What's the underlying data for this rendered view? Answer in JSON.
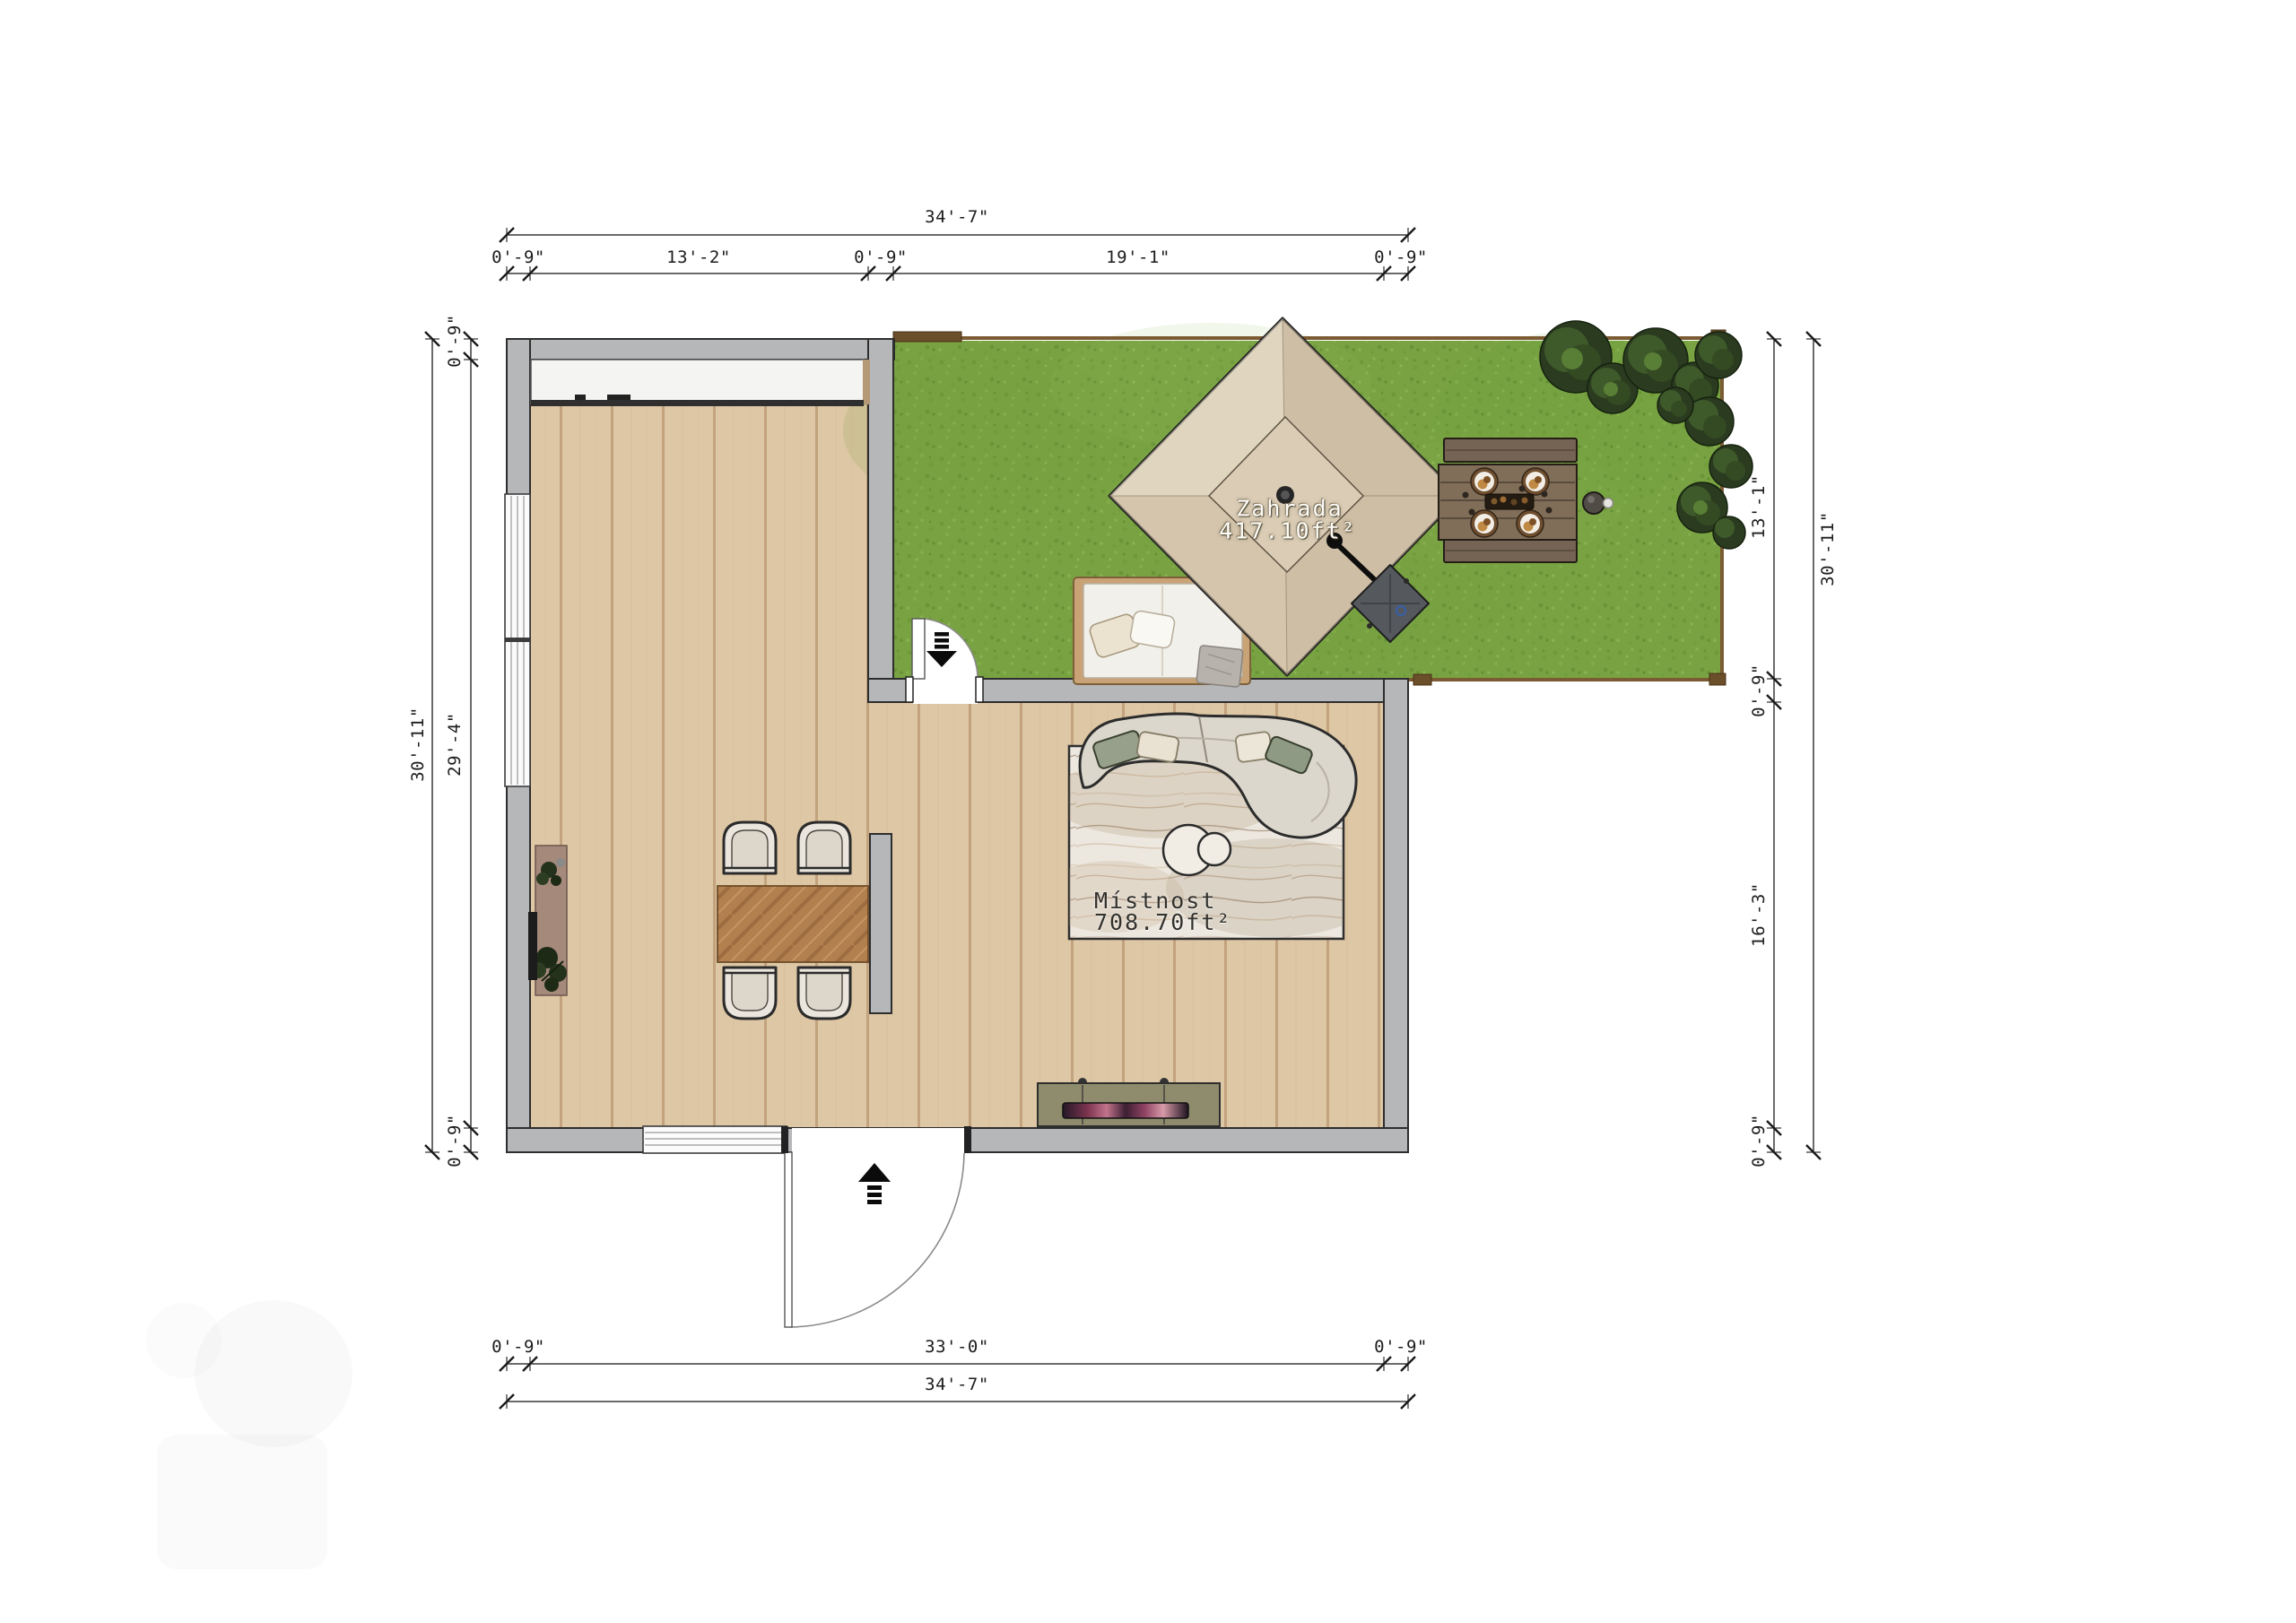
{
  "floor_plan": {
    "rooms": [
      {
        "name": "Zahrada",
        "area": "417.10ft²",
        "type": "garden"
      },
      {
        "name": "Místnost",
        "area": "708.70ft²",
        "type": "living-room"
      }
    ],
    "dimensions": {
      "top": {
        "total": "34'-7\"",
        "segments": [
          "0'-9\"",
          "13'-2\"",
          "0'-9\"",
          "19'-1\"",
          "0'-9\""
        ]
      },
      "bottom": {
        "total": "34'-7\"",
        "segments": [
          "0'-9\"",
          "33'-0\"",
          "0'-9\""
        ]
      },
      "left": {
        "total": "30'-11\"",
        "segments": [
          "0'-9\"",
          "29'-4\"",
          "0'-9\""
        ]
      },
      "right": {
        "total": "30'-11\"",
        "segments": [
          "13'-1\"",
          "0'-9\"",
          "16'-3\"",
          "0'-9\""
        ]
      }
    },
    "icons": [
      {
        "name": "entrance-arrow-icon",
        "glyph": "arrow-up-with-steps"
      },
      {
        "name": "garden-entrance-arrow-icon",
        "glyph": "arrow-down-with-steps"
      }
    ],
    "objects": [
      "garden-tent",
      "umbrella-base",
      "picnic-table",
      "garden-daybed",
      "trees",
      "dining-table",
      "dining-chairs",
      "plant-console",
      "wall-tv",
      "curved-sofa",
      "area-rug",
      "coffee-tables",
      "media-console",
      "closet",
      "left-window",
      "bottom-window",
      "entry-door",
      "garden-door",
      "partition-wall"
    ],
    "colors": {
      "wall": "#b6b7b9",
      "wood_floor": "#ddc6a4",
      "grass": "#79a342",
      "tent_canopy": "#d8cab2",
      "dining_table": "#b5824f",
      "fence": "#7b5b33",
      "dimension_text": "#1c1c1c"
    }
  }
}
